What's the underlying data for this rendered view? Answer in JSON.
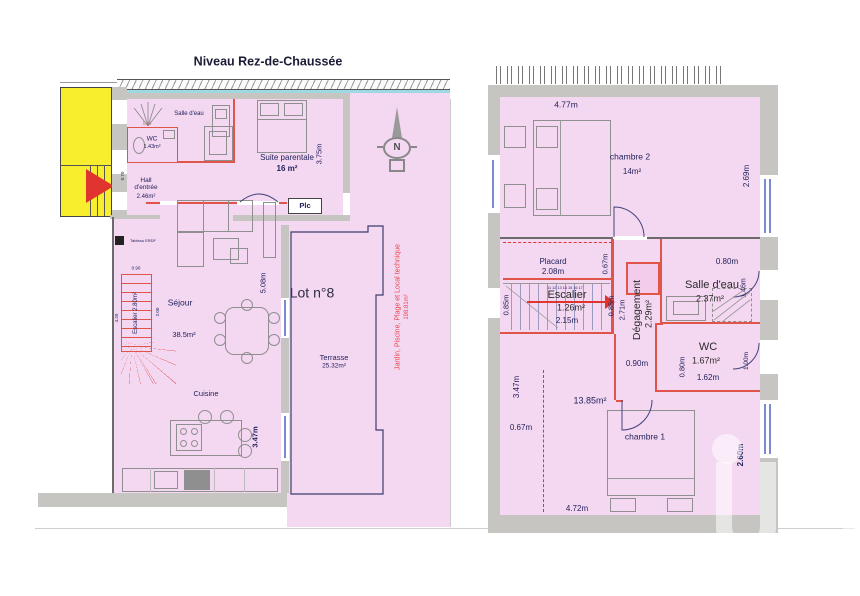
{
  "title": "Niveau Rez-de-Chaussée",
  "compass_letter": "N",
  "colors": {
    "room_fill": "#f4d7f1",
    "wall": "#c6c5c1",
    "exterior_block": "#f8ee2e",
    "partition": "#e0544a",
    "label_navy": "#23235c",
    "outdoor_text_red": "#e8474b",
    "window_blue": "#7c8ad0",
    "water_line_cyan": "#9fd8e2"
  },
  "left": {
    "salle_deau": "Salle d'eau",
    "wc": "WC",
    "wc_area": "1.43m²",
    "hall": "Hall d'entrée",
    "hall_area": "2.46m²",
    "suite": "Suite parentale",
    "suite_area": "16 m²",
    "plc": "Plc",
    "sejour": "Séjour",
    "sejour_area": "38.5m²",
    "cuisine": "Cuisine",
    "stairs": "Escalier 2.80m²",
    "lot": "Lot n°8",
    "terrasse": "Terrasse",
    "terrasse_area": "25.32m²",
    "garden": "Jardin, Piscine, Plage et Local technique",
    "garden_area": "198.81m²",
    "tableau": "Tableau ERDF",
    "dim_suite_h": "3.75m",
    "dim_sejour_h": "5.08m",
    "dim_cuisine_h": "3.47m",
    "dim_stairs_w": "0.90",
    "dim_stairs_h": "2.00",
    "dim_stairs_left": "4.20",
    "dim_wc_w": "1.43",
    "dim_070": "0.70"
  },
  "right": {
    "chambre2": "chambre 2",
    "chambre2_area": "14m²",
    "dim_chambre2_w": "4.77m",
    "dim_chambre2_h": "2.69m",
    "placard": "Placard",
    "placard_dim": "2.08m",
    "dim_067_top": "0.67m",
    "escalier": "Escalier",
    "escalier_area": "1.26m²",
    "escalier_dim": "2.15m",
    "stair_steps": "11 12 13 14 15 16 17",
    "dim_085_left": "0.85m",
    "dim_085_right": "0.85m",
    "dim_271": "2.71m",
    "degagement": "Dégagement",
    "degagement_area": "2.29m²",
    "dim_090": "0.90m",
    "salle_deau": "Salle d'eau",
    "salle_deau_area": "2.37m²",
    "dim_080_top": "0.80m",
    "dim_146": "1.46m",
    "wc": "WC",
    "wc_area": "1.67m²",
    "dim_162": "1.62m",
    "dim_080_left": "0.80m",
    "dim_100": "1.00m",
    "chambre1": "chambre 1",
    "chambre1_area": "13.85m²",
    "dim_347": "3.47m",
    "dim_067_left": "0.67m",
    "dim_472": "4.72m",
    "dim_260": "2.60m"
  }
}
